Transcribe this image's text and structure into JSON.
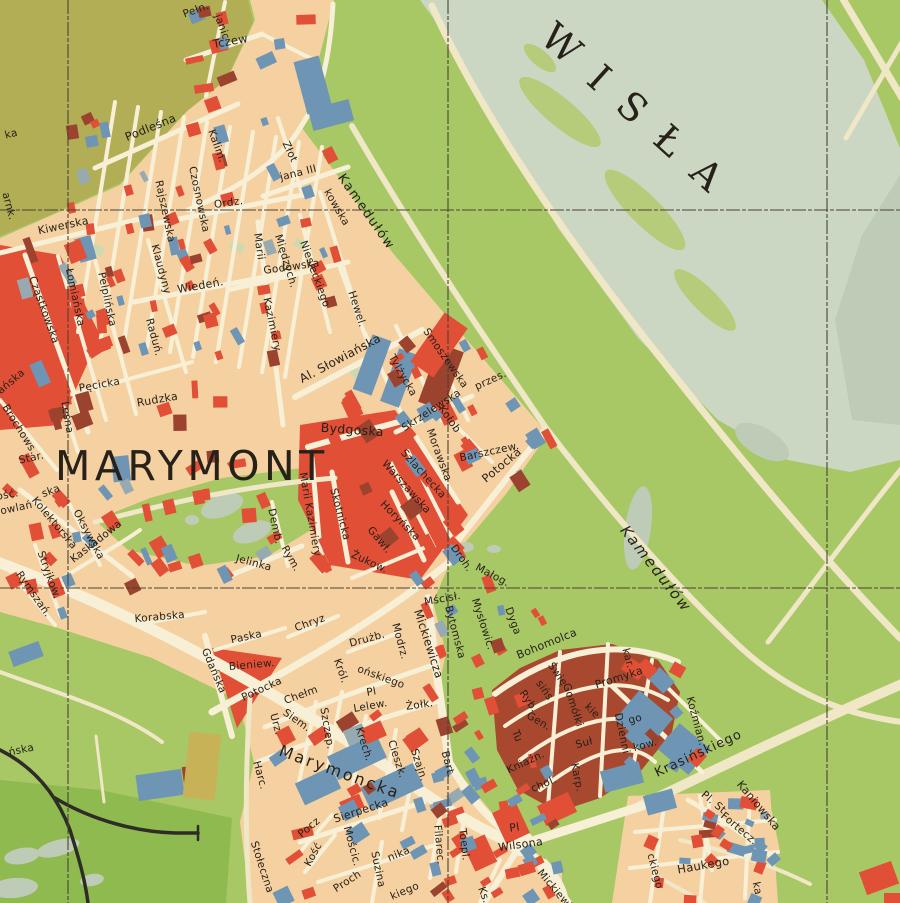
{
  "map": {
    "water_label": "WISŁA",
    "district_label": "MARYMONT",
    "colors": {
      "paper": "#f5d1a2",
      "street": "#f8f0d6",
      "road_green": "#efe7c6",
      "red": "#e14f36",
      "maroon": "#9c4330",
      "blue": "#6f95b4",
      "grayblue": "#97aab2",
      "green": "#a8c765",
      "green_dark": "#8fba50",
      "olive": "#b2ae55",
      "river": "#cbd7c3",
      "sandbar": "#b6cc7b",
      "sage": "#becbb6",
      "mustard": "#c8b258",
      "rail": "#2e2c26",
      "grid": "#4a4334",
      "label": "#27211a",
      "colony": "#a8492f",
      "pale_green_patch": "#cfd9b0"
    },
    "grid": {
      "vertical_x": [
        68,
        448,
        827
      ],
      "horizontal_y": [
        210,
        588
      ]
    },
    "street_labels": [
      {
        "t": "Pełn.",
        "x": 197,
        "y": 13,
        "r": -20
      },
      {
        "t": "janic",
        "x": 219,
        "y": 28,
        "r": 70
      },
      {
        "t": "Tczew",
        "x": 231,
        "y": 45,
        "r": -10,
        "s": 11.5
      },
      {
        "t": "Podleśna",
        "x": 152,
        "y": 131,
        "r": -22,
        "s": 11.5
      },
      {
        "t": "Kalim.",
        "x": 214,
        "y": 147,
        "r": 70
      },
      {
        "t": "Złot",
        "x": 287,
        "y": 153,
        "r": 65
      },
      {
        "t": "jana III",
        "x": 299,
        "y": 176,
        "r": -14
      },
      {
        "t": "kowska",
        "x": 334,
        "y": 209,
        "r": 60
      },
      {
        "t": "Kamedułów",
        "x": 363,
        "y": 214,
        "r": 55,
        "s": 13,
        "ls": 1.5
      },
      {
        "t": "Kiwerska",
        "x": 64,
        "y": 229,
        "r": -12,
        "s": 11
      },
      {
        "t": "Ordz.",
        "x": 229,
        "y": 206,
        "r": -8
      },
      {
        "t": "Rajszewska",
        "x": 162,
        "y": 212,
        "r": 78
      },
      {
        "t": "Czosnowska",
        "x": 196,
        "y": 200,
        "r": 78
      },
      {
        "t": "Klaudyny",
        "x": 158,
        "y": 270,
        "r": 75
      },
      {
        "t": "Międzych.",
        "x": 283,
        "y": 262,
        "r": 73
      },
      {
        "t": "Niesieckiego",
        "x": 312,
        "y": 275,
        "r": 70
      },
      {
        "t": "Marii",
        "x": 256,
        "y": 247,
        "r": 82
      },
      {
        "t": "Kazimiery",
        "x": 269,
        "y": 325,
        "r": 78
      },
      {
        "t": "Godowska",
        "x": 292,
        "y": 270,
        "r": -8
      },
      {
        "t": "Hewel.",
        "x": 354,
        "y": 310,
        "r": 72
      },
      {
        "t": "Wiedeń.",
        "x": 201,
        "y": 289,
        "r": -10,
        "s": 11
      },
      {
        "t": "Cząstkowska",
        "x": 41,
        "y": 311,
        "r": 70
      },
      {
        "t": "Łomiańska",
        "x": 72,
        "y": 298,
        "r": 78
      },
      {
        "t": "Pelplińska",
        "x": 104,
        "y": 300,
        "r": 78
      },
      {
        "t": "Raduń.",
        "x": 151,
        "y": 338,
        "r": 75
      },
      {
        "t": "Pęcicka",
        "x": 100,
        "y": 388,
        "r": -10
      },
      {
        "t": "Rudzka",
        "x": 158,
        "y": 403,
        "r": -10,
        "s": 11
      },
      {
        "t": "Leśna",
        "x": 64,
        "y": 418,
        "r": 80
      },
      {
        "t": "ańska",
        "x": 13,
        "y": 384,
        "r": -40
      },
      {
        "t": "Brochows.",
        "x": 17,
        "y": 431,
        "r": 58
      },
      {
        "t": "Star.",
        "x": 32,
        "y": 461,
        "r": -12
      },
      {
        "t": "ka",
        "x": 12,
        "y": 137,
        "r": -15
      },
      {
        "t": "arnk.",
        "x": 6,
        "y": 207,
        "r": 75
      },
      {
        "t": "Al. Słowiańska",
        "x": 342,
        "y": 362,
        "r": -28,
        "s": 12
      },
      {
        "t": "Tylżycka",
        "x": 400,
        "y": 377,
        "r": 60
      },
      {
        "t": "Smoszewska",
        "x": 443,
        "y": 360,
        "r": 55
      },
      {
        "t": "Skrzelewska",
        "x": 433,
        "y": 413,
        "r": -33
      },
      {
        "t": "Kołob",
        "x": 447,
        "y": 421,
        "r": 55
      },
      {
        "t": "przes.",
        "x": 492,
        "y": 383,
        "r": -25
      },
      {
        "t": "Morawska",
        "x": 436,
        "y": 456,
        "r": 70
      },
      {
        "t": "Szlachecka",
        "x": 421,
        "y": 476,
        "r": 48
      },
      {
        "t": "Warszawska",
        "x": 404,
        "y": 489,
        "r": 48
      },
      {
        "t": "Barszczew.",
        "x": 490,
        "y": 455,
        "r": -12
      },
      {
        "t": "Potocka",
        "x": 504,
        "y": 468,
        "r": -40,
        "s": 11.5
      },
      {
        "t": "Bydgoska",
        "x": 352,
        "y": 434,
        "r": 4,
        "s": 12.5
      },
      {
        "t": "Marii Kazimiery",
        "x": 307,
        "y": 515,
        "r": 80
      },
      {
        "t": "Skotnicka",
        "x": 337,
        "y": 515,
        "r": 75
      },
      {
        "t": "Horyńska",
        "x": 398,
        "y": 523,
        "r": 45
      },
      {
        "t": "Gawł.",
        "x": 377,
        "y": 542,
        "r": 50
      },
      {
        "t": "Żukow.",
        "x": 368,
        "y": 565,
        "r": 25
      },
      {
        "t": "Demb.",
        "x": 272,
        "y": 527,
        "r": 78
      },
      {
        "t": "Rym.",
        "x": 288,
        "y": 560,
        "r": 60
      },
      {
        "t": "Jelinka",
        "x": 253,
        "y": 566,
        "r": 15
      },
      {
        "t": "Kolektorska",
        "x": 52,
        "y": 525,
        "r": 50
      },
      {
        "t": "ska",
        "x": 52,
        "y": 494,
        "r": -20
      },
      {
        "t": "ość.",
        "x": 8,
        "y": 498,
        "r": -10
      },
      {
        "t": "owlań",
        "x": 17,
        "y": 511,
        "r": -12
      },
      {
        "t": "Oksywska",
        "x": 86,
        "y": 536,
        "r": 62
      },
      {
        "t": "Kaskadowa",
        "x": 98,
        "y": 544,
        "r": -38
      },
      {
        "t": "Stryjkow.",
        "x": 46,
        "y": 576,
        "r": 70
      },
      {
        "t": "Rymszań.",
        "x": 31,
        "y": 596,
        "r": 55
      },
      {
        "t": "Korabska",
        "x": 160,
        "y": 620,
        "r": -5
      },
      {
        "t": "Paska",
        "x": 247,
        "y": 640,
        "r": -12
      },
      {
        "t": "Chryz",
        "x": 311,
        "y": 626,
        "r": -20
      },
      {
        "t": "Drużb.",
        "x": 368,
        "y": 642,
        "r": -15
      },
      {
        "t": "Modrz.",
        "x": 397,
        "y": 642,
        "r": 75
      },
      {
        "t": "Gdańska",
        "x": 211,
        "y": 672,
        "r": 67
      },
      {
        "t": "Bieniew.",
        "x": 252,
        "y": 668,
        "r": -5
      },
      {
        "t": "Potocka",
        "x": 263,
        "y": 692,
        "r": -25
      },
      {
        "t": "Chełm",
        "x": 302,
        "y": 698,
        "r": -20
      },
      {
        "t": "Król.",
        "x": 338,
        "y": 672,
        "r": 70
      },
      {
        "t": "ońskiego",
        "x": 380,
        "y": 680,
        "r": 20
      },
      {
        "t": "Pl",
        "x": 372,
        "y": 695,
        "r": -10
      },
      {
        "t": "Lelew.",
        "x": 371,
        "y": 709,
        "r": -10
      },
      {
        "t": "Żołk.",
        "x": 420,
        "y": 708,
        "r": -8
      },
      {
        "t": "Mickiewicza",
        "x": 425,
        "y": 645,
        "r": 72,
        "s": 11.5
      },
      {
        "t": "Mścisł.",
        "x": 443,
        "y": 602,
        "r": -10
      },
      {
        "t": "Droh.",
        "x": 459,
        "y": 560,
        "r": 55
      },
      {
        "t": "Małog.",
        "x": 491,
        "y": 578,
        "r": 28
      },
      {
        "t": "Bytomska",
        "x": 452,
        "y": 633,
        "r": 75
      },
      {
        "t": "Mysłowic.",
        "x": 480,
        "y": 625,
        "r": 72
      },
      {
        "t": "Dyga",
        "x": 510,
        "y": 622,
        "r": 70
      },
      {
        "t": "Bohomolca",
        "x": 548,
        "y": 647,
        "r": -22,
        "s": 11
      },
      {
        "t": "Kamedułów",
        "x": 652,
        "y": 572,
        "r": 52,
        "s": 15,
        "ls": 2,
        "f": "serif",
        "i": 1
      },
      {
        "t": "Promyka",
        "x": 620,
        "y": 681,
        "r": -18,
        "s": 11
      },
      {
        "t": "kar.",
        "x": 625,
        "y": 659,
        "r": 75
      },
      {
        "t": "Świę",
        "x": 555,
        "y": 676,
        "r": 55
      },
      {
        "t": "sińs",
        "x": 542,
        "y": 692,
        "r": 55
      },
      {
        "t": "kie",
        "x": 590,
        "y": 713,
        "r": 45
      },
      {
        "t": "Ryb.",
        "x": 526,
        "y": 703,
        "r": 55
      },
      {
        "t": "Gen.",
        "x": 537,
        "y": 724,
        "r": 30
      },
      {
        "t": "Gomółki",
        "x": 570,
        "y": 706,
        "r": 72
      },
      {
        "t": "Suł",
        "x": 585,
        "y": 746,
        "r": -15
      },
      {
        "t": "go",
        "x": 636,
        "y": 722,
        "r": -15
      },
      {
        "t": "kow.",
        "x": 646,
        "y": 748,
        "r": -15
      },
      {
        "t": "Dzienni",
        "x": 619,
        "y": 734,
        "r": 78
      },
      {
        "t": "Kniaźn.",
        "x": 527,
        "y": 765,
        "r": -25
      },
      {
        "t": "Karp.",
        "x": 574,
        "y": 778,
        "r": 78
      },
      {
        "t": "Tu",
        "x": 514,
        "y": 737,
        "r": 70
      },
      {
        "t": "chol.",
        "x": 545,
        "y": 787,
        "r": -23
      },
      {
        "t": "Siem.",
        "x": 295,
        "y": 723,
        "r": 35
      },
      {
        "t": "Urz.",
        "x": 273,
        "y": 725,
        "r": 75
      },
      {
        "t": "Szczep.",
        "x": 324,
        "y": 729,
        "r": 80
      },
      {
        "t": "Krech.",
        "x": 361,
        "y": 745,
        "r": 72
      },
      {
        "t": "Cieszk.",
        "x": 394,
        "y": 760,
        "r": 72
      },
      {
        "t": "Szajn.",
        "x": 416,
        "y": 766,
        "r": 72
      },
      {
        "t": "Marymoncka",
        "x": 338,
        "y": 777,
        "r": 20,
        "s": 16,
        "ls": 2.5
      },
      {
        "t": "Harc.",
        "x": 257,
        "y": 776,
        "r": 75
      },
      {
        "t": "Bart.",
        "x": 445,
        "y": 765,
        "r": 75
      },
      {
        "t": "Stołeczna",
        "x": 259,
        "y": 868,
        "r": 72
      },
      {
        "t": "Pocz",
        "x": 311,
        "y": 830,
        "r": -40
      },
      {
        "t": "Kość",
        "x": 316,
        "y": 856,
        "r": -62
      },
      {
        "t": "Sierpecka",
        "x": 362,
        "y": 814,
        "r": -18,
        "s": 11
      },
      {
        "t": "Mościc.",
        "x": 349,
        "y": 847,
        "r": 75
      },
      {
        "t": "Proch",
        "x": 349,
        "y": 884,
        "r": -33
      },
      {
        "t": "nika",
        "x": 400,
        "y": 857,
        "r": -22
      },
      {
        "t": "Suzina",
        "x": 375,
        "y": 870,
        "r": 78
      },
      {
        "t": "Filarec.",
        "x": 436,
        "y": 845,
        "r": 85
      },
      {
        "t": "Toepl.",
        "x": 461,
        "y": 845,
        "r": 83
      },
      {
        "t": "kiego",
        "x": 406,
        "y": 894,
        "r": -23
      },
      {
        "t": "Ks.",
        "x": 481,
        "y": 896,
        "r": 70
      },
      {
        "t": "Pl",
        "x": 515,
        "y": 831,
        "r": -8,
        "s": 11
      },
      {
        "t": "Wilsona",
        "x": 521,
        "y": 848,
        "r": -8,
        "s": 11
      },
      {
        "t": "Mickiewicza",
        "x": 558,
        "y": 898,
        "r": 50
      },
      {
        "t": "Krasińskiego",
        "x": 700,
        "y": 757,
        "r": -25,
        "s": 13,
        "ls": 1
      },
      {
        "t": "Koźmian.",
        "x": 693,
        "y": 722,
        "r": 75
      },
      {
        "t": "Kaniowska",
        "x": 756,
        "y": 808,
        "r": 50,
        "s": 11
      },
      {
        "t": "Pl. St.",
        "x": 713,
        "y": 806,
        "r": 40
      },
      {
        "t": "Fortecz.",
        "x": 737,
        "y": 831,
        "r": 40
      },
      {
        "t": "Haukego",
        "x": 704,
        "y": 869,
        "r": -10,
        "s": 11.5
      },
      {
        "t": "ckiego",
        "x": 652,
        "y": 872,
        "r": 75
      },
      {
        "t": "ka",
        "x": 754,
        "y": 889,
        "r": 78
      },
      {
        "t": "ńska",
        "x": 22,
        "y": 753,
        "r": -12
      }
    ]
  }
}
